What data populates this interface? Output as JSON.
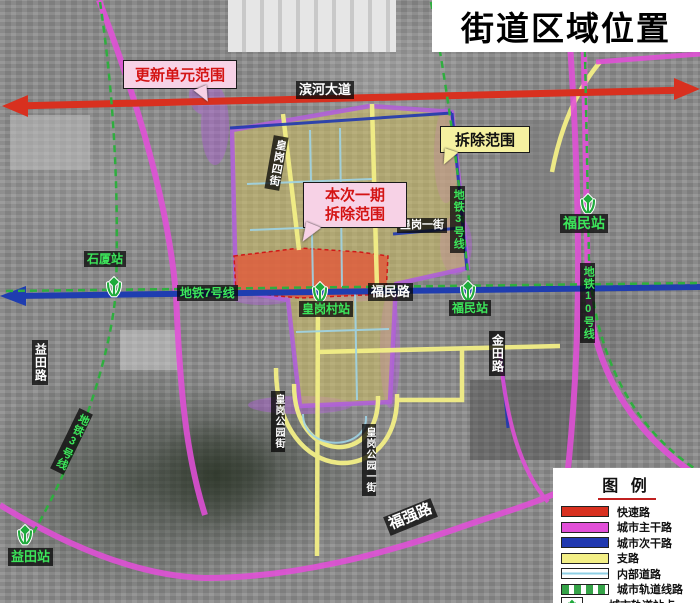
{
  "title": "街道区域位置",
  "callouts": {
    "update_unit": "更新单元范围",
    "demolition": "拆除范围",
    "phase1_line1": "本次一期",
    "phase1_line2": "拆除范围"
  },
  "roads": {
    "binhe_avenue": "滨河大道",
    "fumin_road": "福民路",
    "huanggang_4th_street": "皇岗四街",
    "huanggang_1st_street": "皇岗一街",
    "jintian_road": "金田路",
    "yitian_road": "益田路",
    "huanggang_park_street": "皇岗公园街",
    "huanggang_park_1st_street": "皇岗公园一街",
    "fuqiang_road": "福强路"
  },
  "metro": {
    "line7_label": "地铁7号线",
    "line3_label_north": "地铁3号线",
    "line3_label_southwest": "地铁3号线",
    "line10_label": "地铁10号线",
    "shixia_station": "石厦站",
    "huanggangcun_station": "皇岗村站",
    "fumin_station_center": "福民站",
    "fumin_station_northeast": "福民站",
    "yitian_station": "益田站"
  },
  "legend": {
    "title": "图 例",
    "items": [
      {
        "label": "快速路",
        "swatch": "bar",
        "color": "#d8301f"
      },
      {
        "label": "城市主干路",
        "swatch": "bar",
        "color": "#e24fd8"
      },
      {
        "label": "城市次干路",
        "swatch": "bar",
        "color": "#2038b0"
      },
      {
        "label": "支路",
        "swatch": "bar",
        "color": "#f3ef86"
      },
      {
        "label": "内部道路",
        "swatch": "line",
        "color": "#8ecfe4"
      },
      {
        "label": "城市轨道线路",
        "swatch": "dashed",
        "color": "#35a348"
      },
      {
        "label": "城市轨道站点",
        "swatch": "icon",
        "color": "#1faa3c"
      }
    ]
  },
  "colors": {
    "expressway": "#d8301f",
    "arterial": "#e24fd8",
    "secondary": "#2038b0",
    "branch_road": "#f3ef86",
    "internal_road": "#8ecfe4",
    "rail_line": "#35a348",
    "unit_boundary": "#b060d8",
    "zone_fill": "#d6c35e",
    "demolition_fill": "#e2593a",
    "callout_pink": "#f7d2e6",
    "callout_yellow": "#f5f1a0"
  }
}
